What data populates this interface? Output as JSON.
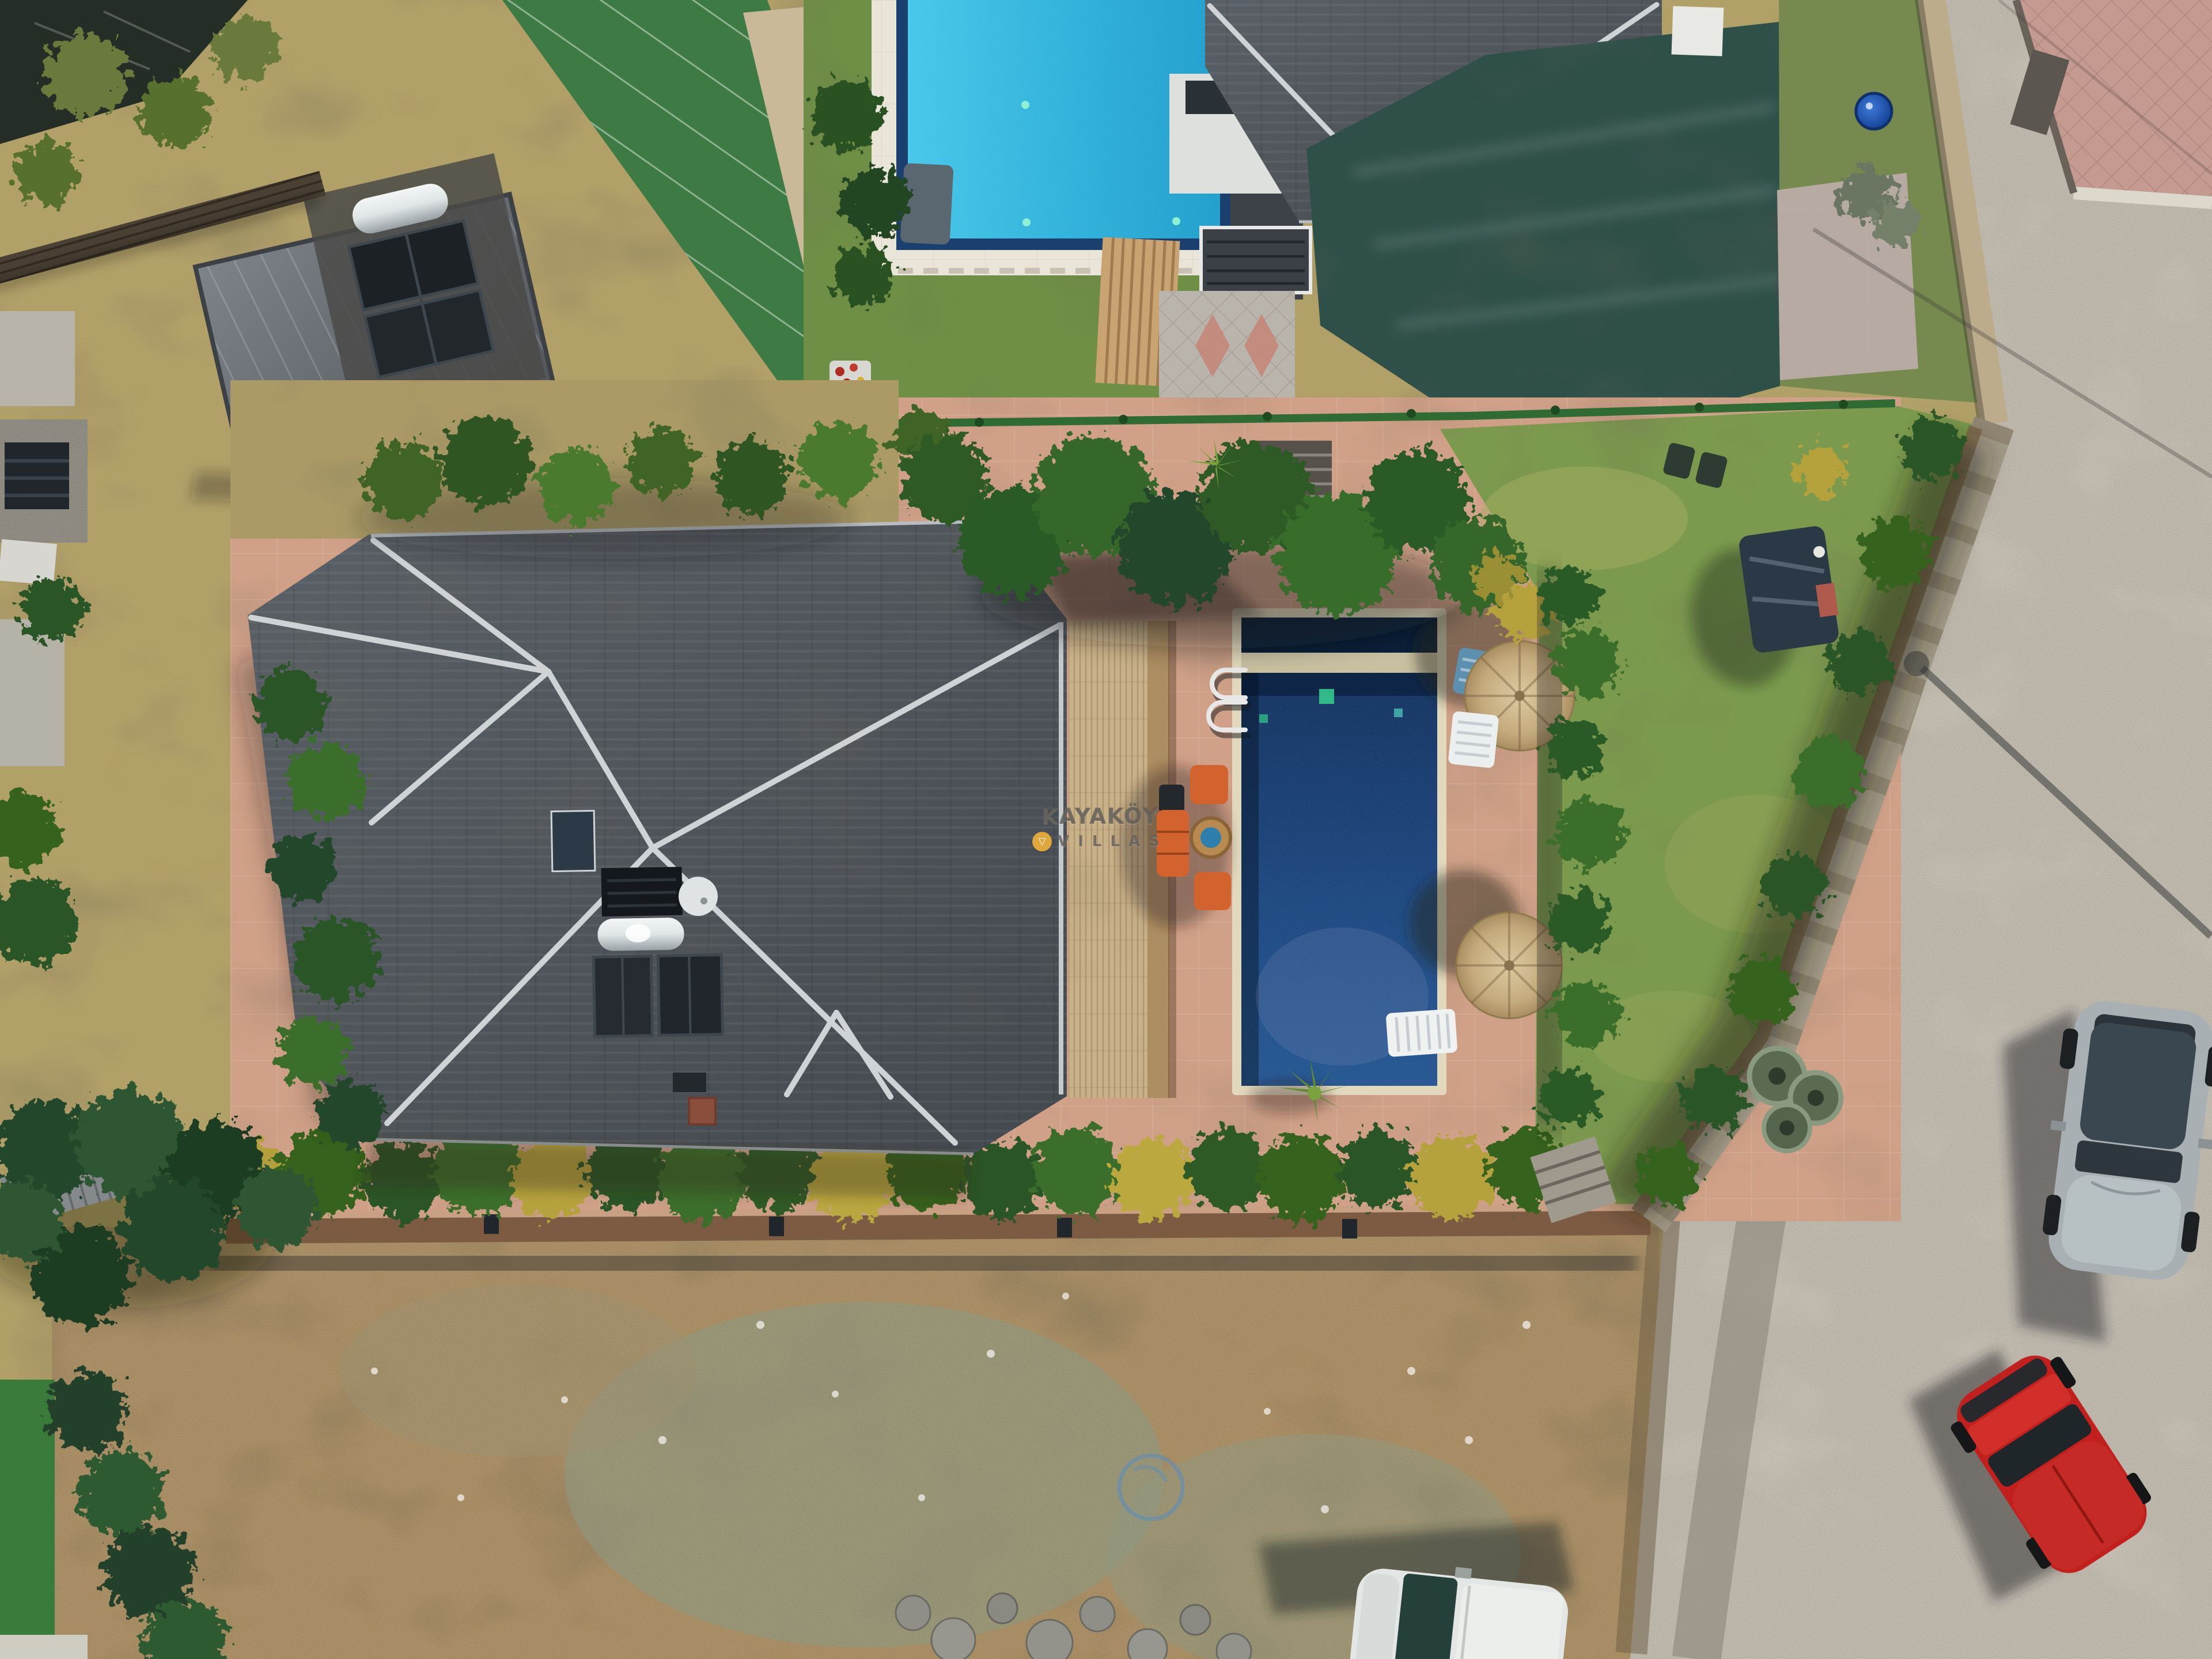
{
  "scene": {
    "type": "aerial-drone-photo",
    "caption": "Top-down aerial view of a villa: dark-blue private pool on a terracotta patio with straw umbrellas and orange garden furniture, dark hip roof with solar water heater, green lawn, neighbouring houses with a turquoise pool and green shade tarp, and a gravel road with parked cars",
    "watermark": {
      "line1": "KAYAKÖY",
      "line2": "VILLAS",
      "logo_icon": "triangle-in-yellow-circle",
      "logo_glyph": "▽",
      "logo_color": "#dfa83c",
      "text_color": "#625c56"
    },
    "palette": {
      "villa_pool_water": "#16386b",
      "pool_overflow_channel": "#0a1f38",
      "pool_stone_band": "#c9c0a2",
      "neighbor_pool_water": "#2fb2d9",
      "neighbor_pool_border": "#1b3f6e",
      "patio_terracotta": "#cf9f86",
      "straw_roof": "#c9b28a",
      "villa_roof_tiles": "#4e545b",
      "roof_ridge_caps": "#cfd3d6",
      "lawn_green": "#7c9a4e",
      "tree_green": "#2c5a26",
      "yellow_shrub": "#b5a23e",
      "road_gravel": "#c7c1b5",
      "dirt_lot": "#b3976c",
      "shade_tarp": "#2f5049",
      "stone_wall": "#a39a88",
      "silver_car": "#a8b0b3",
      "red_car": "#c2201f",
      "white_car": "#e3e6e4"
    },
    "objects": [
      "villa-hip-roof",
      "roof-ridge-caps",
      "skylight",
      "satellite-dish",
      "solar-water-heater",
      "solar-panels",
      "chimney",
      "straw-pergola-roof",
      "swimming-pool",
      "pool-ladder",
      "pool-lights",
      "straw-umbrella",
      "umbrella-shadow",
      "sun-lounger-blue",
      "sun-lounger-white",
      "orange-sofa-set",
      "round-wicker-table",
      "barbecue",
      "yucca-plant",
      "terracotta-patio",
      "villa-lawn",
      "garden-rings",
      "covered-trailer",
      "garden-chairs",
      "flower-bed",
      "boundary-stone-wall",
      "bottom-wall",
      "hedge-row",
      "wall-lights",
      "entrance-steps",
      "stone-steps",
      "green-fence",
      "neighbor-pool-turquoise",
      "neighbor-pool-deck",
      "pool-roller",
      "neighbor-house-roof",
      "terrace-awning",
      "wooden-steps",
      "paver-driveway",
      "shade-tarp",
      "paver-path",
      "covered-round-pool",
      "capped-wall",
      "barn-metal-roof",
      "barn-solar-panels",
      "boiler-tank",
      "louver-fence",
      "mesh-fence",
      "stone-house",
      "shed-roof",
      "trees",
      "dry-scrub",
      "vacant-dirt-lot",
      "stones",
      "hose-ring",
      "gravel-road",
      "street-lamp-shadow",
      "power-line-shadow",
      "tire-tracks",
      "silver-car",
      "red-car",
      "white-car",
      "pink-driveway"
    ]
  }
}
